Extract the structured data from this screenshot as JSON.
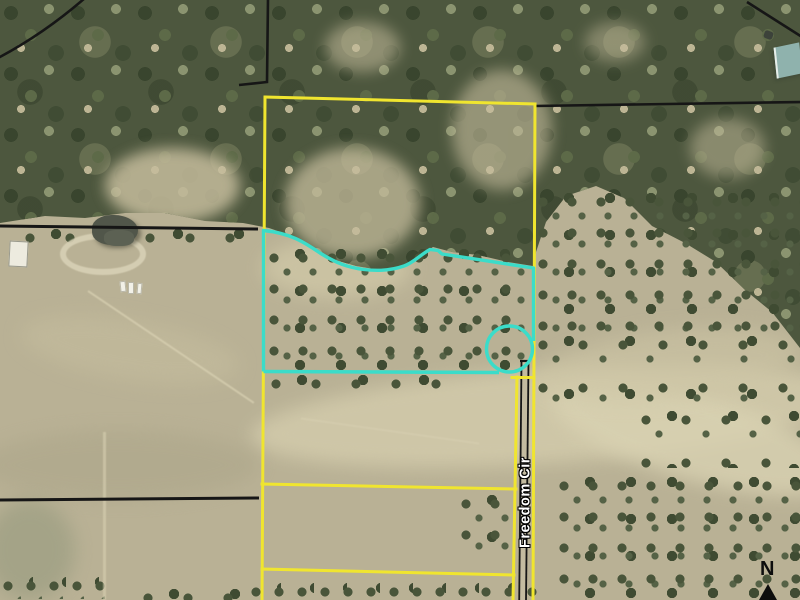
{
  "map": {
    "road_label": "Freedom Cir",
    "north_label": "N"
  },
  "colors": {
    "parcel_line": "#f0e52f",
    "highlight_line": "#3bdcc9",
    "road_line": "#161616",
    "road_surface": "#c3bba0",
    "label_text": "#ffffff",
    "north_color": "#0d0d0d"
  }
}
